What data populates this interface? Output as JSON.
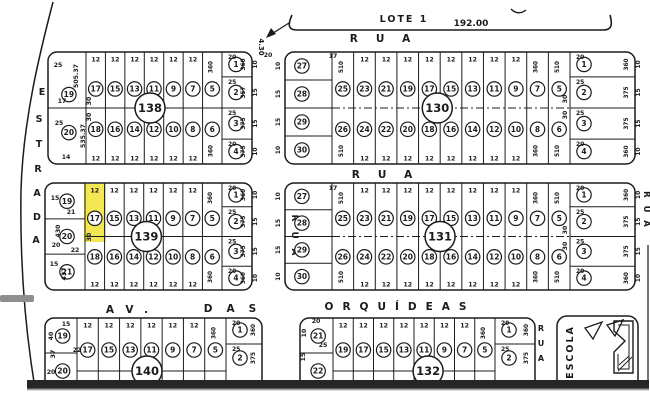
{
  "map": {
    "palette": {
      "ink": "#1b1b1b",
      "paper": "#ffffff",
      "highlight": "#f2e336",
      "bar": "#262626",
      "bar_shadow": "#9b9b9b",
      "smudge": "#8e8e8e"
    },
    "header": {
      "lote_label": "LOTE 1",
      "lote_measure": "192.00",
      "arrow_dim": "4.30"
    },
    "streets": {
      "rua_top": "RUA",
      "rua_mid": "RUA",
      "estrada": "ESTRADA",
      "rua_vertical_center": "RUA",
      "rua_vertical_right": "RUA",
      "rua_vertical_bottom": "RUA",
      "avenue_part1": "AV.",
      "avenue_part2": "DAS",
      "avenue_part3": "ORQUÍDEAS",
      "escola": "ESCOLA"
    },
    "highlighted_lot": {
      "block": "139",
      "lot": "17",
      "color": "#f2e336"
    },
    "blocks": [
      {
        "number": "138",
        "x": 48,
        "y": 52,
        "w": 204,
        "h": 112,
        "leftW": 38,
        "rightW": 30,
        "cxf": 0.5,
        "dash": false,
        "left_lots": [
          "19",
          "20"
        ],
        "grid_top": [
          "17",
          "15",
          "13",
          "11",
          "9",
          "7",
          "5"
        ],
        "grid_bottom": [
          "18",
          "16",
          "14",
          "12",
          "10",
          "8",
          "6"
        ],
        "top_dims": [
          "12",
          "12",
          "12",
          "12",
          "12",
          "12",
          "360"
        ],
        "bottom_dims": [
          "12",
          "12",
          "12",
          "12",
          "12",
          "12",
          "360"
        ],
        "right_lots": [
          "1",
          "2",
          "3",
          "4"
        ],
        "right_widths": [
          20,
          25,
          25,
          20
        ],
        "right_side": [
          "10",
          "15",
          "15",
          "10"
        ],
        "right_depths": [
          "360",
          "357",
          "375",
          "375"
        ],
        "extras": [
          {
            "t": "505.37",
            "x": 78,
            "y": 76,
            "r": -90
          },
          {
            "t": "535.37",
            "x": 85,
            "y": 136,
            "r": -90
          },
          {
            "t": "25",
            "x": 58,
            "y": 67
          },
          {
            "t": "17",
            "x": 62,
            "y": 103
          },
          {
            "t": "25",
            "x": 59,
            "y": 125
          },
          {
            "t": "14",
            "x": 66,
            "y": 159
          },
          {
            "t": "30",
            "x": 91,
            "y": 101,
            "r": -90
          },
          {
            "t": "30",
            "x": 91,
            "y": 117,
            "r": -90
          },
          {
            "t": "20",
            "x": 268,
            "y": 57
          }
        ]
      },
      {
        "number": "130",
        "x": 285,
        "y": 52,
        "w": 350,
        "h": 112,
        "leftW": 47,
        "rightW": 65,
        "cxf": 0.435,
        "dash": true,
        "left_lots": [
          "27",
          "28",
          "29",
          "30"
        ],
        "left_side": [
          "10",
          "15",
          "15",
          "10"
        ],
        "grid_top": [
          "25",
          "23",
          "21",
          "19",
          "17",
          "15",
          "13",
          "11",
          "9",
          "7",
          "5"
        ],
        "grid_bottom": [
          "26",
          "24",
          "22",
          "20",
          "18",
          "16",
          "14",
          "12",
          "10",
          "8",
          "6"
        ],
        "top_dims": [
          "510",
          "12",
          "12",
          "12",
          "12",
          "12",
          "12",
          "12",
          "12",
          "360",
          "510"
        ],
        "bottom_dims": [
          "510",
          "12",
          "12",
          "12",
          "12",
          "12",
          "12",
          "12",
          "12",
          "360",
          "510"
        ],
        "right_lots": [
          "1",
          "2",
          "3",
          "4"
        ],
        "right_widths": [
          20,
          25,
          25,
          20
        ],
        "right_side": [
          "10",
          "15",
          "15",
          "10"
        ],
        "right_depths": [
          "360",
          "375",
          "375",
          "360"
        ],
        "extras": [
          {
            "t": "17",
            "x": 333,
            "y": 58
          },
          {
            "t": "30",
            "x": 567,
            "y": 99,
            "r": -90
          },
          {
            "t": "30",
            "x": 567,
            "y": 115,
            "r": -90
          }
        ]
      },
      {
        "number": "139",
        "x": 45,
        "y": 183,
        "w": 207,
        "h": 107,
        "leftW": 40,
        "rightW": 30,
        "cxf": 0.49,
        "dash": false,
        "left_lots": [
          "19",
          "20",
          "21"
        ],
        "grid_top": [
          "17",
          "15",
          "13",
          "11",
          "9",
          "7",
          "5"
        ],
        "grid_bottom": [
          "18",
          "16",
          "14",
          "12",
          "10",
          "8",
          "6"
        ],
        "top_dims": [
          "12",
          "12",
          "12",
          "12",
          "12",
          "12",
          "360"
        ],
        "bottom_dims": [
          "12",
          "12",
          "12",
          "12",
          "12",
          "12",
          "360"
        ],
        "right_lots": [
          "1",
          "2",
          "3",
          "4"
        ],
        "right_widths": [
          20,
          25,
          25,
          20
        ],
        "right_side": [
          "10",
          "15",
          "15",
          "10"
        ],
        "right_depths": [
          "360",
          "375",
          "375",
          "360"
        ],
        "highlight": {
          "lot": "17",
          "col": 0
        },
        "extras": [
          {
            "t": "15",
            "x": 55,
            "y": 200
          },
          {
            "t": "21",
            "x": 71,
            "y": 214
          },
          {
            "t": "430",
            "x": 60,
            "y": 231,
            "r": -90
          },
          {
            "t": "20",
            "x": 56,
            "y": 247
          },
          {
            "t": "22",
            "x": 75,
            "y": 252
          },
          {
            "t": "15",
            "x": 54,
            "y": 266
          },
          {
            "t": "437",
            "x": 66,
            "y": 274,
            "r": -90
          },
          {
            "t": "30",
            "x": 91,
            "y": 237,
            "r": -90
          }
        ]
      },
      {
        "number": "131",
        "x": 285,
        "y": 183,
        "w": 350,
        "h": 107,
        "leftW": 47,
        "rightW": 65,
        "cxf": 0.443,
        "dash": true,
        "left_lots": [
          "27",
          "28",
          "29",
          "30"
        ],
        "left_side": [
          "10",
          "15",
          "15",
          "10"
        ],
        "grid_top": [
          "25",
          "23",
          "21",
          "19",
          "17",
          "15",
          "13",
          "11",
          "9",
          "7",
          "5"
        ],
        "grid_bottom": [
          "26",
          "24",
          "22",
          "20",
          "18",
          "16",
          "14",
          "12",
          "10",
          "8",
          "6"
        ],
        "top_dims": [
          "510",
          "12",
          "12",
          "12",
          "12",
          "12",
          "12",
          "12",
          "12",
          "360",
          "510"
        ],
        "bottom_dims": [
          "510",
          "12",
          "12",
          "12",
          "12",
          "12",
          "12",
          "12",
          "12",
          "360",
          "510"
        ],
        "right_lots": [
          "1",
          "2",
          "3",
          "4"
        ],
        "right_widths": [
          20,
          25,
          25,
          20
        ],
        "right_side": [
          "10",
          "15",
          "15",
          "10"
        ],
        "right_depths": [
          "360",
          "375",
          "375",
          "360"
        ],
        "extras": [
          {
            "t": "17",
            "x": 333,
            "y": 190
          },
          {
            "t": "30",
            "x": 567,
            "y": 230,
            "r": -90
          },
          {
            "t": "30",
            "x": 567,
            "y": 246,
            "r": -90
          }
        ]
      },
      {
        "number": "140",
        "x": 45,
        "y": 318,
        "w": 217,
        "h": 100,
        "leftW": 32,
        "rightW": 36,
        "cxf": 0.47,
        "dash": false,
        "cut": true,
        "left_lots": [
          "19",
          "20"
        ],
        "grid_top": [
          "17",
          "15",
          "13",
          "11",
          "9",
          "7",
          "5"
        ],
        "top_dims": [
          "12",
          "12",
          "12",
          "12",
          "12",
          "12",
          "360"
        ],
        "right_lots": [
          "1",
          "2"
        ],
        "right_widths": [
          20,
          25
        ],
        "right_depths": [
          "360",
          "375"
        ],
        "extras": [
          {
            "t": "15",
            "x": 66,
            "y": 326
          },
          {
            "t": "40",
            "x": 53,
            "y": 336,
            "r": -90
          },
          {
            "t": "37",
            "x": 55,
            "y": 354,
            "r": -90
          },
          {
            "t": "20",
            "x": 51,
            "y": 374
          },
          {
            "t": "22",
            "x": 77,
            "y": 352
          }
        ]
      },
      {
        "number": "132",
        "x": 300,
        "y": 318,
        "w": 235,
        "h": 100,
        "leftW": 33,
        "rightW": 40,
        "cxf": 0.545,
        "dash": false,
        "cut": true,
        "left_lots": [
          "21",
          "22"
        ],
        "grid_top": [
          "19",
          "17",
          "15",
          "13",
          "11",
          "9",
          "7",
          "5"
        ],
        "top_dims": [
          "12",
          "12",
          "12",
          "12",
          "12",
          "12",
          "12",
          "360"
        ],
        "right_lots": [
          "1",
          "2"
        ],
        "right_widths": [
          20,
          25
        ],
        "right_depths": [
          "360",
          "375"
        ],
        "extras": [
          {
            "t": "20",
            "x": 316,
            "y": 323
          },
          {
            "t": "25",
            "x": 323,
            "y": 347
          },
          {
            "t": "10",
            "x": 306,
            "y": 333,
            "r": -90
          },
          {
            "t": "15",
            "x": 305,
            "y": 357,
            "r": -90
          }
        ]
      }
    ]
  }
}
